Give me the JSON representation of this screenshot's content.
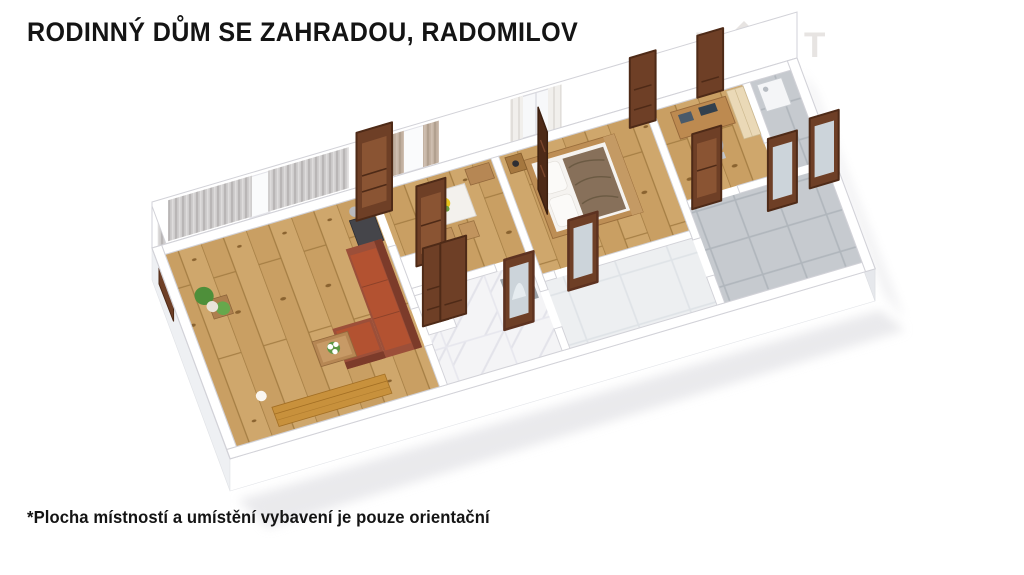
{
  "header": {
    "title": "RODINNÝ DŮM SE ZAHRADOU, RADOMILOV"
  },
  "watermark": {
    "letter_n": "N",
    "letter_x": "X",
    "letter_t": "T"
  },
  "footer": {
    "disclaimer": "*Plocha místností a umístění vybavení je pouze orientační"
  },
  "colors": {
    "pageBg": "#ffffff",
    "titleText": "#141414",
    "watermark": "#e7e4e2",
    "wall": "#ffffff",
    "wallEdge": "#d2d2d8",
    "wallShade": "#eef0f3",
    "wallShade2": "#e6e8ec",
    "wood": "#c99f63",
    "woodSeam": "#a37c42",
    "marble": "#f4f4f6",
    "tileLight": "#edeff1",
    "tileGray": "#c6cacf",
    "door": "#6e3f26",
    "doorDark": "#4e2a17",
    "doorPanel": "#8a5433",
    "mirror": "#ccd4da",
    "mirrorLight": "#e9eef2",
    "sofa": "#9c4f39",
    "sofaSeat": "#b35231",
    "sofaDark": "#7c3b2a",
    "bench": "#c8913c",
    "curtain": "#cfcdcd",
    "curtainDark": "#b9b6b6",
    "curtainTan": "#c3b2a2",
    "curtainWhite": "#f1efec",
    "bedFrame": "#bd8e55",
    "blanket": "#87705a",
    "stove": "#45454a",
    "plant": "#4e8f3a",
    "tableWood": "#b68754",
    "tableWhite": "#f3f1ed",
    "flowerYellow": "#e7c41f",
    "wardrobe": "#ead9b7",
    "appliance": "#f4f5f7",
    "shadow": "#d9d9de"
  }
}
